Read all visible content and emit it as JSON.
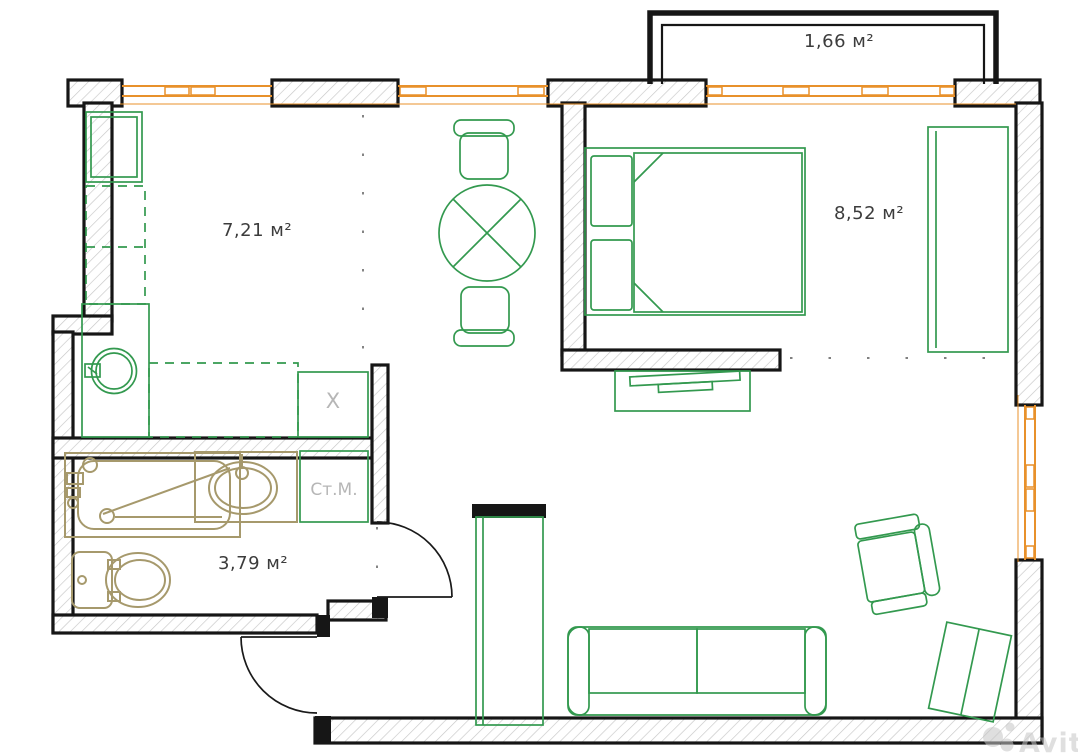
{
  "title": "apartment-floor-plan",
  "rooms": {
    "kitchen": {
      "area_label": "7,21 м²"
    },
    "bedroom": {
      "area_label": "8,52 м²"
    },
    "bathroom": {
      "area_label": "3,79 м²"
    },
    "balcony": {
      "area_label": "1,66 м²"
    }
  },
  "annotations": {
    "washing_machine": "Ст.М.",
    "stove_mark": "X"
  },
  "watermark": {
    "text": "Avito"
  },
  "colors": {
    "wall": "#161616",
    "hatch": "#c7c7c7",
    "furniture_green": "#33994f",
    "fixture_tan": "#a6996c",
    "window_orange": "#e8912b",
    "muted_label": "#b6b6b6",
    "area_label": "#3c3c3c",
    "watermark_gray": "#c6c6c6"
  }
}
